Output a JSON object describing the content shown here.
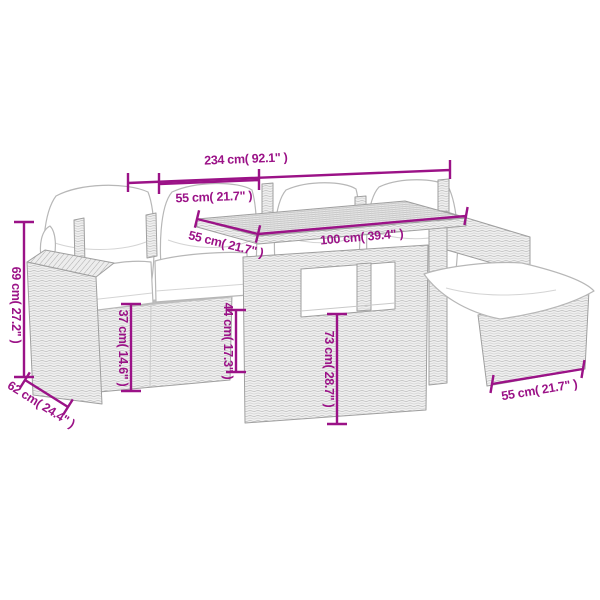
{
  "diagram": {
    "type": "product-dimension-diagram",
    "subject": "rattan-garden-sofa-set-with-table-and-footstool",
    "background": "#ffffff"
  },
  "colors": {
    "dimension_accent": "#9B1287",
    "line_art": "#9f9f9f",
    "rattan_fill": "#f0f0f0",
    "cushion_fill": "#ffffff"
  },
  "dims": {
    "total_width": "234 cm( 92.1\" )",
    "seat_width": "55 cm( 21.7\" )",
    "table_depth": "55 cm( 21.7\" )",
    "table_length": "100 cm( 39.4\" )",
    "back_height": "69 cm( 27.2\" )",
    "seat_height": "37 cm( 14.6\" )",
    "shelf_height": "44 cm( 17.3\" )",
    "table_height": "73 cm( 28.7\" )",
    "sofa_depth": "62 cm( 24.4\" )",
    "stool_width": "55 cm( 21.7\" )"
  }
}
